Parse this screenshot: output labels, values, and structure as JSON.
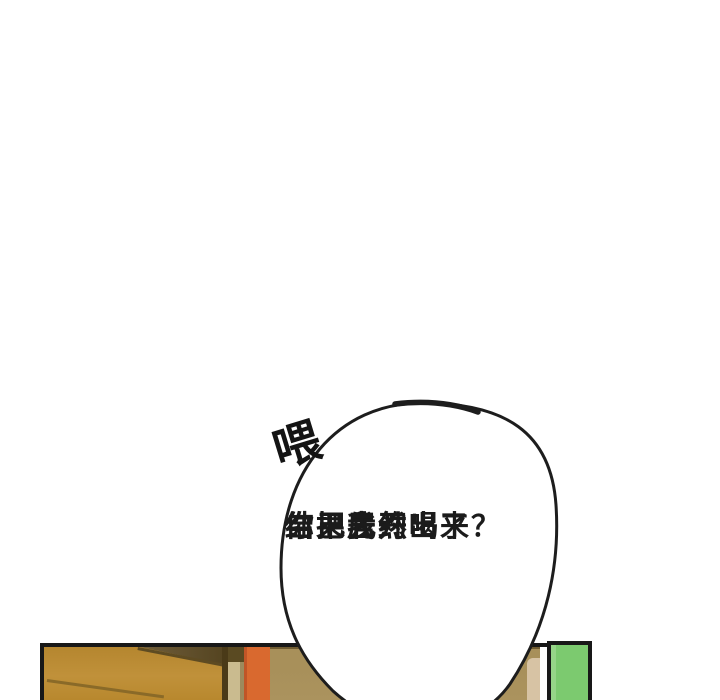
{
  "panel": {
    "type": "comic-panel",
    "sfx": {
      "text": "喂"
    },
    "speech": {
      "lines": [
        "你把我约出来",
        "结果居然",
        "自己先开喝了？"
      ]
    },
    "colors": {
      "outline": "#1a1a1a",
      "wood_door": "#bb8a30",
      "wood_shadow": "#584722",
      "door_edge": "#cabb8f",
      "orange_frame": "#d9692f",
      "wall_khaki": "#a8905a",
      "green_panel": "#7cca6f",
      "background": "#ffffff"
    }
  }
}
